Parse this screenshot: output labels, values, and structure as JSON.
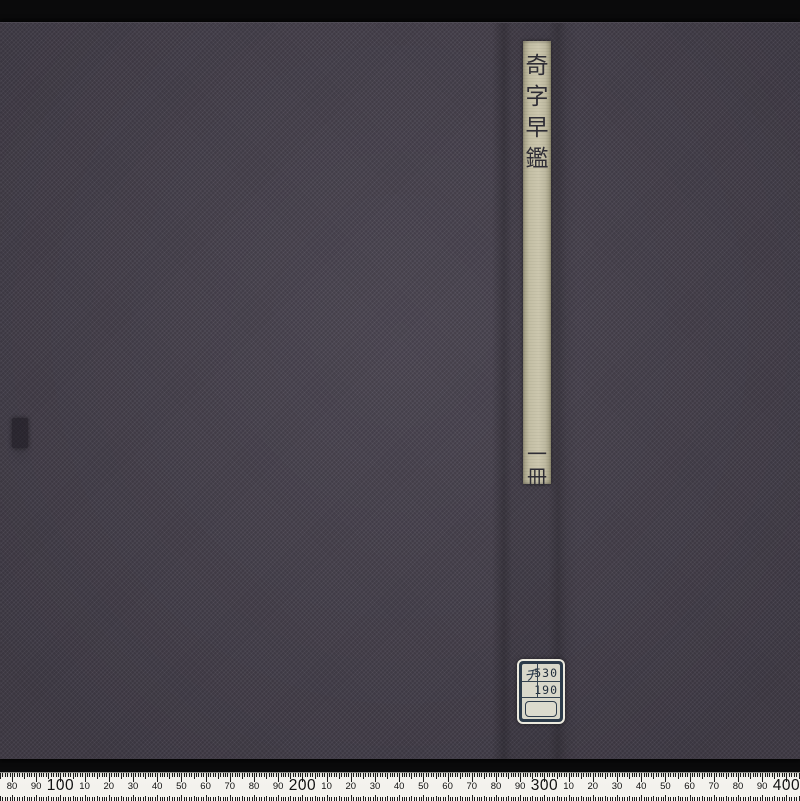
{
  "scene": {
    "description_background": "black photographic backdrop",
    "colors": {
      "backdrop": "#0a0a0b",
      "cover_cloth": "#46414c",
      "title_strip_paper": "#c3bea4",
      "ink": "#2e2d35",
      "label_border": "#2c3b4a",
      "label_paper": "#d9d8ca",
      "ruler_background": "#f2f1ec"
    }
  },
  "book": {
    "title_vertical": "奇字早鑑",
    "title_chars": [
      "奇",
      "字",
      "早",
      "鑑"
    ],
    "volume_label": "一冊",
    "volume_chars": [
      "一",
      "冊"
    ]
  },
  "call_number_label": {
    "prefix": "チ",
    "line1": "530",
    "line2": "190"
  },
  "ruler": {
    "unit": "mm",
    "origin_x_px": 12,
    "origin_value_mm": 80,
    "px_per_mm": 2.42,
    "mm_start": 75,
    "mm_end": 406,
    "labels": [
      {
        "mm": 80,
        "text": "80"
      },
      {
        "mm": 90,
        "text": "90"
      },
      {
        "mm": 100,
        "text": "100",
        "big": true
      },
      {
        "mm": 110,
        "text": "10"
      },
      {
        "mm": 120,
        "text": "20"
      },
      {
        "mm": 130,
        "text": "30"
      },
      {
        "mm": 140,
        "text": "40"
      },
      {
        "mm": 150,
        "text": "50"
      },
      {
        "mm": 160,
        "text": "60"
      },
      {
        "mm": 170,
        "text": "70"
      },
      {
        "mm": 180,
        "text": "80"
      },
      {
        "mm": 190,
        "text": "90"
      },
      {
        "mm": 200,
        "text": "200",
        "big": true
      },
      {
        "mm": 210,
        "text": "10"
      },
      {
        "mm": 220,
        "text": "20"
      },
      {
        "mm": 230,
        "text": "30"
      },
      {
        "mm": 240,
        "text": "40"
      },
      {
        "mm": 250,
        "text": "50"
      },
      {
        "mm": 260,
        "text": "60"
      },
      {
        "mm": 270,
        "text": "70"
      },
      {
        "mm": 280,
        "text": "80"
      },
      {
        "mm": 290,
        "text": "90"
      },
      {
        "mm": 300,
        "text": "300",
        "big": true
      },
      {
        "mm": 310,
        "text": "10"
      },
      {
        "mm": 320,
        "text": "20"
      },
      {
        "mm": 330,
        "text": "30"
      },
      {
        "mm": 340,
        "text": "40"
      },
      {
        "mm": 350,
        "text": "50"
      },
      {
        "mm": 360,
        "text": "60"
      },
      {
        "mm": 370,
        "text": "70"
      },
      {
        "mm": 380,
        "text": "80"
      },
      {
        "mm": 390,
        "text": "90"
      },
      {
        "mm": 400,
        "text": "400",
        "big": true
      }
    ]
  }
}
